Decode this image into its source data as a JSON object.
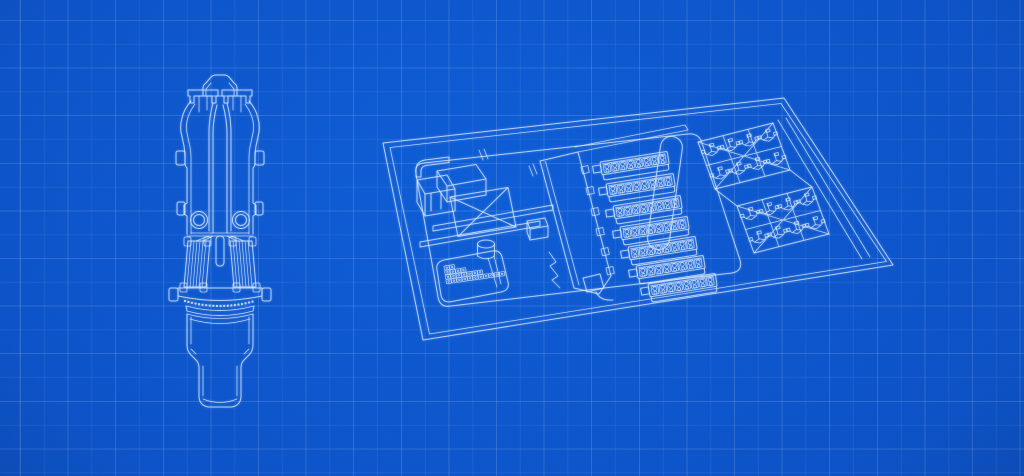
{
  "app": {
    "name": "blueprint-wallpaper",
    "description": "Blueprint-style engineering schematic on blue grid paper, no text"
  },
  "colors": {
    "bg_center": "#0c5cd6",
    "bg_mid": "#0b52c8",
    "bg_edge": "#0845ae",
    "vignette": "rgba(4,22,66,0.30)",
    "grid_major": "rgba(200,223,255,0.17)",
    "grid_minor": "rgba(200,223,255,0.08)",
    "line": "#dbe9fb",
    "line_soft": "rgba(219,233,251,0.55)"
  },
  "grid": {
    "major_spacing_px": 47.6,
    "minor_spacing_px": 23.8,
    "offset_px": 20
  },
  "figures": [
    {
      "id": "vessel",
      "label": "vessel cross-section drawing"
    },
    {
      "id": "factory",
      "label": "factory floor isometric drawing"
    }
  ],
  "counts": {
    "battery_strips": 7,
    "cells_per_strip": 8,
    "panel_grids": 2,
    "symbols_per_grid": 8,
    "crate_pile_boxes": 25
  }
}
